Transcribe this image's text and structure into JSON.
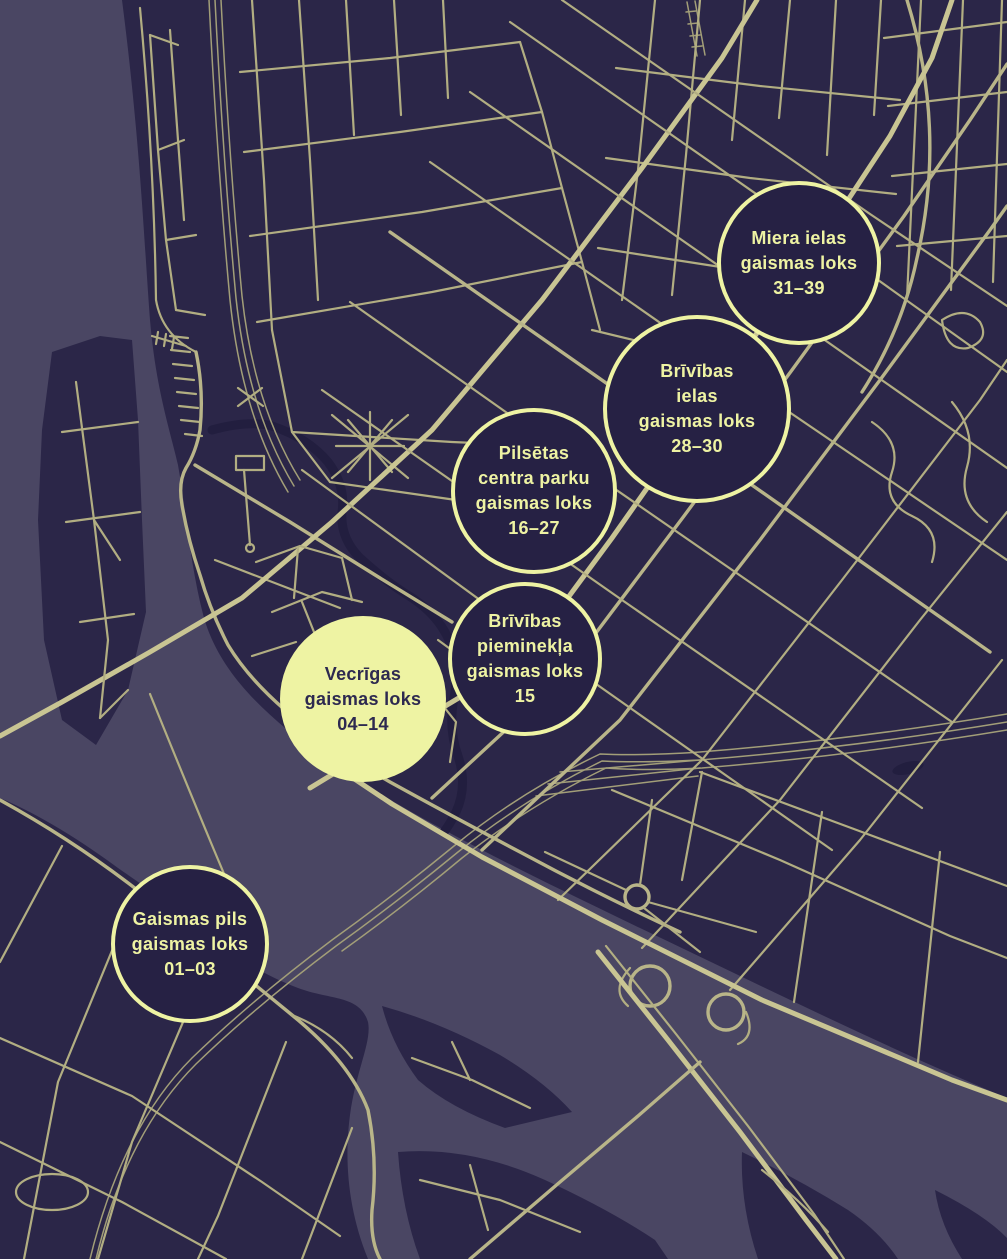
{
  "map": {
    "city": "Rīga",
    "colors": {
      "background": "#2b2648",
      "water": "#4a4663",
      "street": "#b2ae82",
      "main_road": "#c9c593",
      "accent": "#eef3a3",
      "marker_dark_fill": "#262144",
      "dark_text": "#2d2950"
    }
  },
  "markers": [
    {
      "name": "miera-ielas",
      "variant": "outlined",
      "lines": [
        "Miera ielas",
        "gaismas loks",
        "31–39"
      ]
    },
    {
      "name": "brivibas-ielas",
      "variant": "outlined",
      "lines": [
        "Brīvības",
        "ielas",
        "gaismas loks",
        "28–30"
      ]
    },
    {
      "name": "pilsetas-centra-parku",
      "variant": "outlined",
      "lines": [
        "Pilsētas",
        "centra parku",
        "gaismas loks",
        "16–27"
      ]
    },
    {
      "name": "brivibas-pieminekla",
      "variant": "outlined",
      "lines": [
        "Brīvības",
        "pieminekļa",
        "gaismas loks",
        "15"
      ]
    },
    {
      "name": "vecrigas",
      "variant": "filled",
      "lines": [
        "Vecrīgas",
        "gaismas loks",
        "04–14"
      ]
    },
    {
      "name": "gaismas-pils",
      "variant": "outlined",
      "lines": [
        "Gaismas pils",
        "gaismas loks",
        "01–03"
      ]
    }
  ]
}
